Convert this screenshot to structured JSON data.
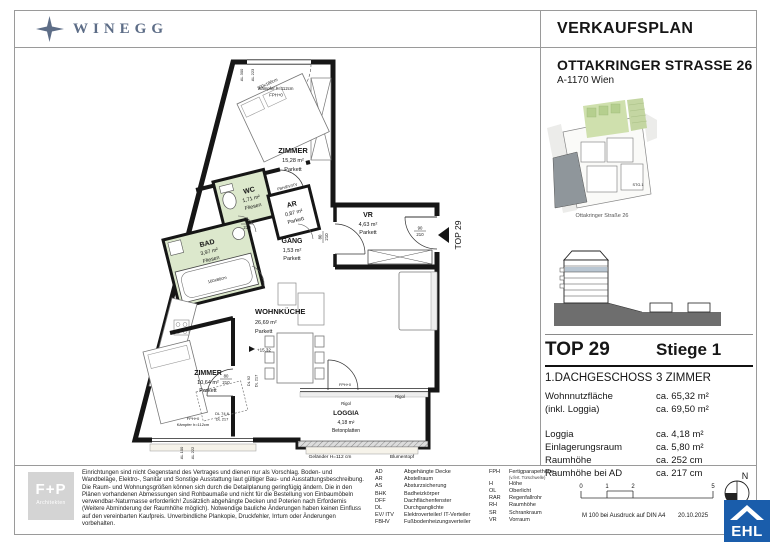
{
  "colors": {
    "brand_navy": "#5d6d87",
    "ehl_blue": "#1a5dab",
    "room_green": "#dce8cc"
  },
  "header": {
    "brand": "WINEGG",
    "title": "VERKAUFSPLAN"
  },
  "project": {
    "address": "OTTAKRINGER STRASSE 26",
    "city": "A-1170 Wien"
  },
  "sitemap": {
    "stg": "STG.1",
    "caption": "Ottakringer Straße 26"
  },
  "unit": {
    "top": "TOP 29",
    "stiege": "Stiege 1",
    "floor": "1.DACHGESCHOSS",
    "rooms": "3 ZIMMER",
    "area_rows": [
      {
        "label": "Wohnnutzfläche",
        "value": "ca. 65,32 m²"
      },
      {
        "label": "(inkl. Loggia)",
        "value": "ca. 69,50 m²"
      }
    ],
    "detail_rows": [
      {
        "label": "Loggia",
        "value": "ca. 4,18 m²"
      },
      {
        "label": "Einlagerungsraum",
        "value": "ca. 5,80 m²"
      },
      {
        "label": "Raumhöhe",
        "value": "ca. 252 cm"
      },
      {
        "label": "Raumhöhe bei AD",
        "value": "ca. 217 cm"
      }
    ]
  },
  "plan": {
    "rooms": {
      "zimmer1": {
        "name": "ZIMMER",
        "area": "15,28 m²",
        "floor": "Parkett"
      },
      "wc": {
        "name": "WC",
        "area": "1,71 m²",
        "floor": "Fliesen"
      },
      "ar": {
        "name": "AR",
        "area": "0,87 m²",
        "floor": "Parkett"
      },
      "bad": {
        "name": "BAD",
        "area": "3,97 m²",
        "floor": "Fliesen"
      },
      "gang": {
        "name": "GANG",
        "area": "1,53 m²",
        "floor": "Parkett"
      },
      "vr": {
        "name": "VR",
        "area": "4,63 m²",
        "floor": "Parkett"
      },
      "wohnkueche": {
        "name": "WOHNKÜCHE",
        "area": "26,69 m²",
        "floor": "Parkett"
      },
      "zimmer2": {
        "name": "ZIMMER",
        "area": "10,64 m²",
        "floor": "Parkett"
      },
      "loggia": {
        "name": "LOGGIA",
        "area": "4,18 m²",
        "floor": "Betonplatten"
      }
    },
    "ann": {
      "al300": "AL 300",
      "al223": "AL 223",
      "kaempfer": "Kämpfer h=112cm",
      "fph0": "FPH+0",
      "bed_size": "200x180cm",
      "fbh": "FBH/EV/ITV",
      "tub_size": "160x80cm",
      "d80": "80",
      "d90": "90",
      "d210": "210",
      "level": "+15,32",
      "dl92": "DL 92",
      "dl217": "DL 217",
      "dl746": "DL 74,6",
      "al100": "AL 100",
      "al222": "AL 222",
      "rigol": "Rigol",
      "gelaender": "Geländer H=112 cm",
      "blumentopf": "Blumentopf",
      "top_marker": "TOP 29"
    }
  },
  "legend": {
    "col1": [
      {
        "abbr": "AD",
        "term": "Abgehängte Decke"
      },
      {
        "abbr": "AR",
        "term": "Abstellraum"
      },
      {
        "abbr": "AS",
        "term": "Absturzsicherung"
      },
      {
        "abbr": "BHK",
        "term": "Badheizkörper"
      },
      {
        "abbr": "DFF",
        "term": "Dachflächenfenster"
      },
      {
        "abbr": "DL",
        "term": "Durchganglichte"
      },
      {
        "abbr": "EV/ ITV",
        "term": "Elektroverteiler/ IT-Verteiler"
      },
      {
        "abbr": "FBHV",
        "term": "Fußbodenheizungsverteiler"
      }
    ],
    "col2": [
      {
        "abbr": "FPH",
        "term": "Fertigparapethöhe"
      },
      {
        "abbr": "H",
        "term": "Höhe"
      },
      {
        "abbr": "OL",
        "term": "Oberlicht"
      },
      {
        "abbr": "RAR",
        "term": "Regenfallrohr"
      },
      {
        "abbr": "RH",
        "term": "Raumhöhe"
      },
      {
        "abbr": "SR",
        "term": "Schrankraum"
      },
      {
        "abbr": "VR",
        "term": "Vorraum"
      }
    ],
    "fph_note": "(v.fert. Türschwelle)"
  },
  "footer": {
    "architect": {
      "name": "F+P",
      "sub": "Architekten"
    },
    "disclaimer": "Einrichtungen sind nicht Gegenstand des Vertrages und dienen nur als Vorschlag. Boden- und Wandbeläge, Elektro-, Sanitär und Sonstige Ausstattung laut gültiger Bau- und Ausstattungsbeschreibung. Die Raum- und Wohnungsgrößen können sich durch die Detailplanung geringfügig ändern. Die in den Plänen vorhandenen Abmessungen sind Rohbaumaße und nicht für die Bestellung von Einbaumöbeln verwendbar-Naturmasse erforderlich! Zusätzlich abgehängte Decken und Poterien nach Erfordernis (Weitere Abminderung der Raumhöhe möglich). Notwendige bauliche Änderungen haben keinen Einfluss auf den vereinbarten Kaufpreis. Unverbindliche Plankopie, Druckfehler, Irrtum oder Änderungen vorbehalten.",
    "scale": {
      "t0": "0",
      "t1": "1",
      "t2": "2",
      "t5": "5",
      "note": "M 100 bei Ausdruck auf DIN A4",
      "date": "20.10.2025"
    },
    "north": "N",
    "ehl": "EHL"
  }
}
